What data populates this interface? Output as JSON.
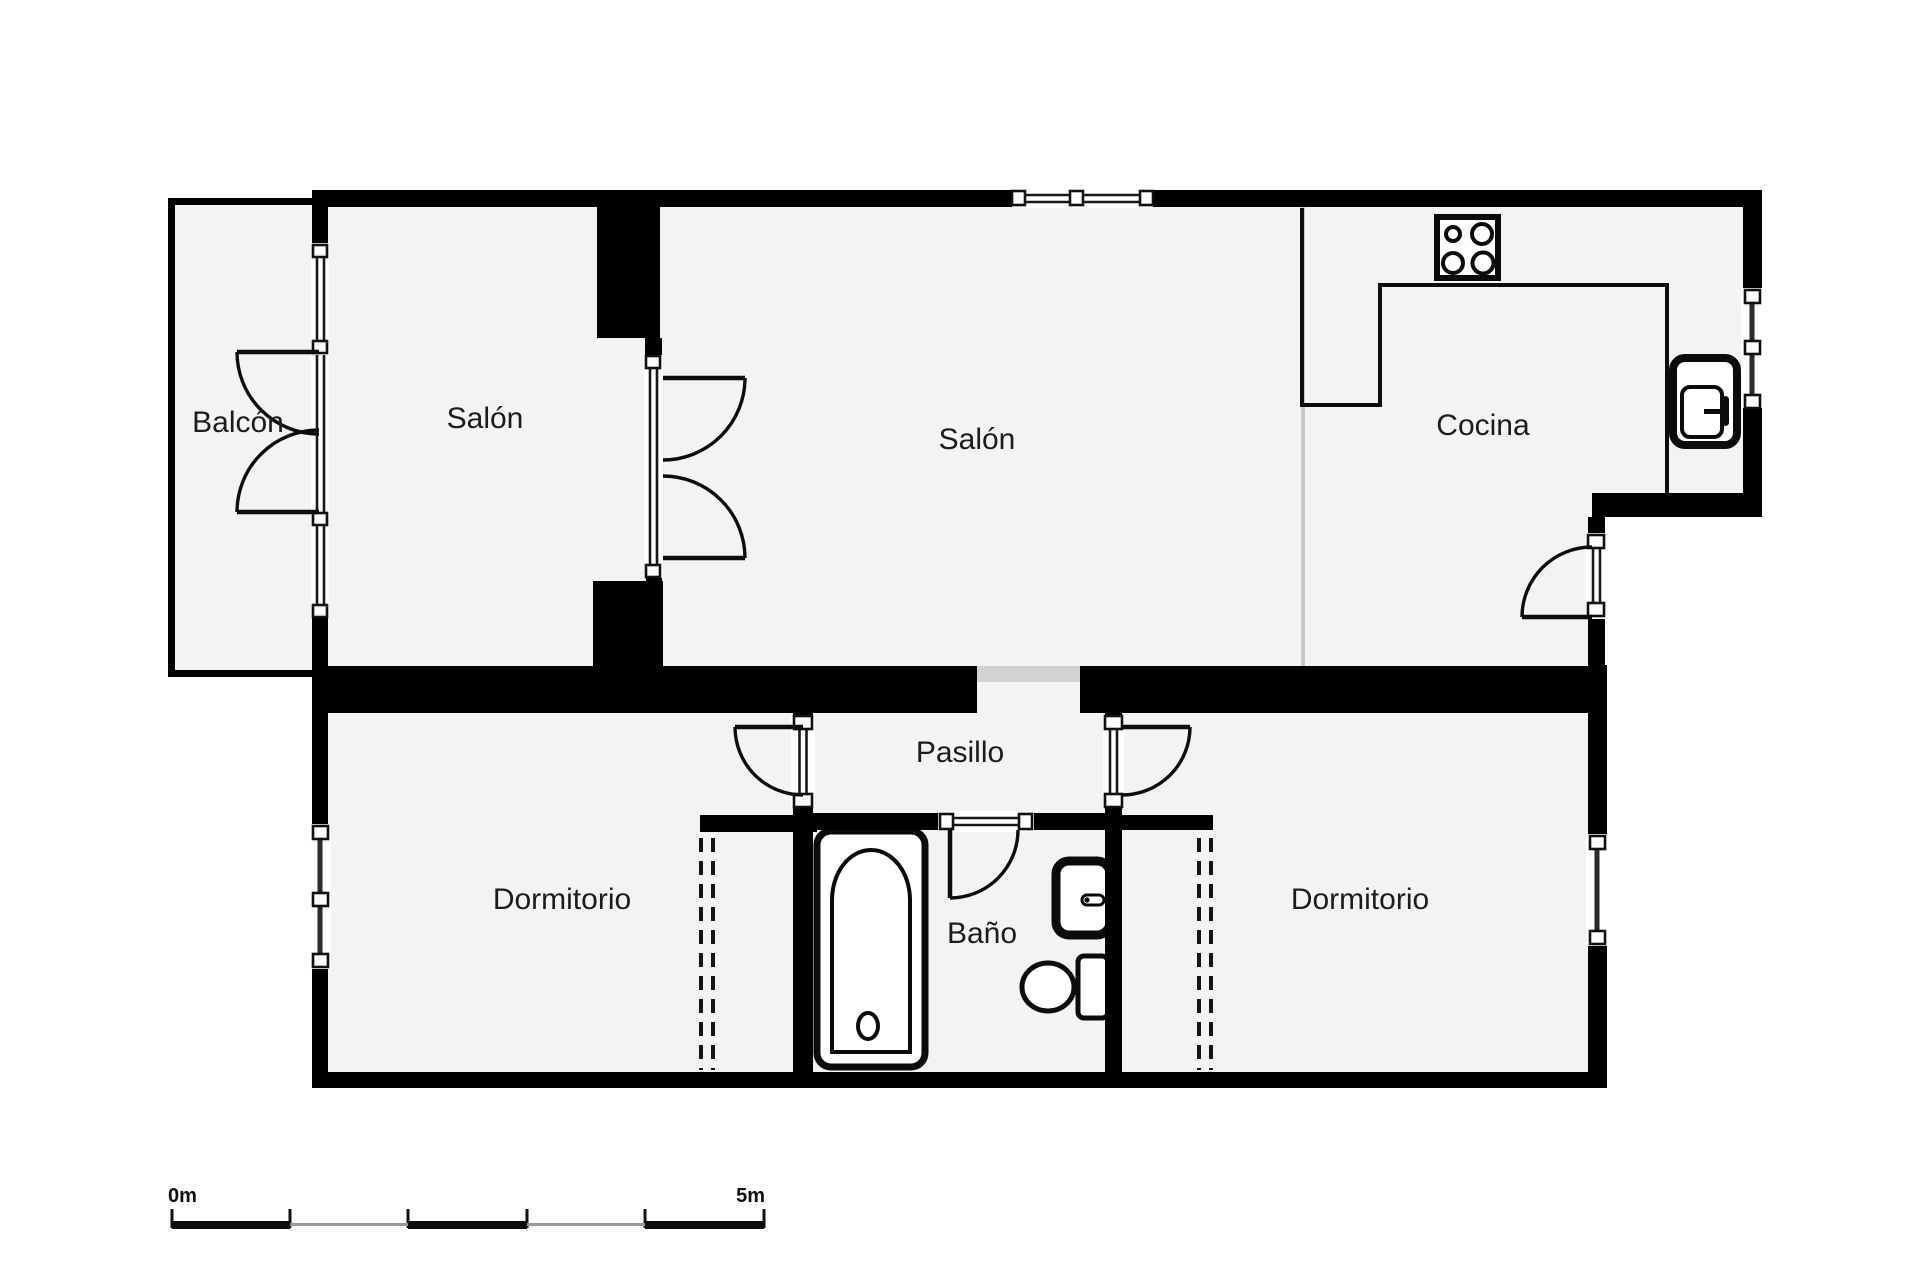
{
  "plan": {
    "rooms": {
      "balcon": {
        "label": "Balcón"
      },
      "salon_left": {
        "label": "Salón"
      },
      "salon_main": {
        "label": "Salón"
      },
      "cocina": {
        "label": "Cocina"
      },
      "pasillo": {
        "label": "Pasillo"
      },
      "dormitorio_left": {
        "label": "Dormitorio"
      },
      "bano": {
        "label": "Baño"
      },
      "dormitorio_right": {
        "label": "Dormitorio"
      }
    },
    "fixtures": [
      "stove",
      "kitchen-sink",
      "bathtub",
      "toilet",
      "washbasin"
    ],
    "scale_bar": {
      "start_label": "0m",
      "end_label": "5m",
      "total_meters": 5,
      "segments": 5
    }
  },
  "colors": {
    "background": "#ffffff",
    "wall": "#000000",
    "room_fill": "#f3f3f3",
    "opening": "#d2d2d2",
    "boundary": "#c9c9c9",
    "text": "#1c1c1c"
  }
}
